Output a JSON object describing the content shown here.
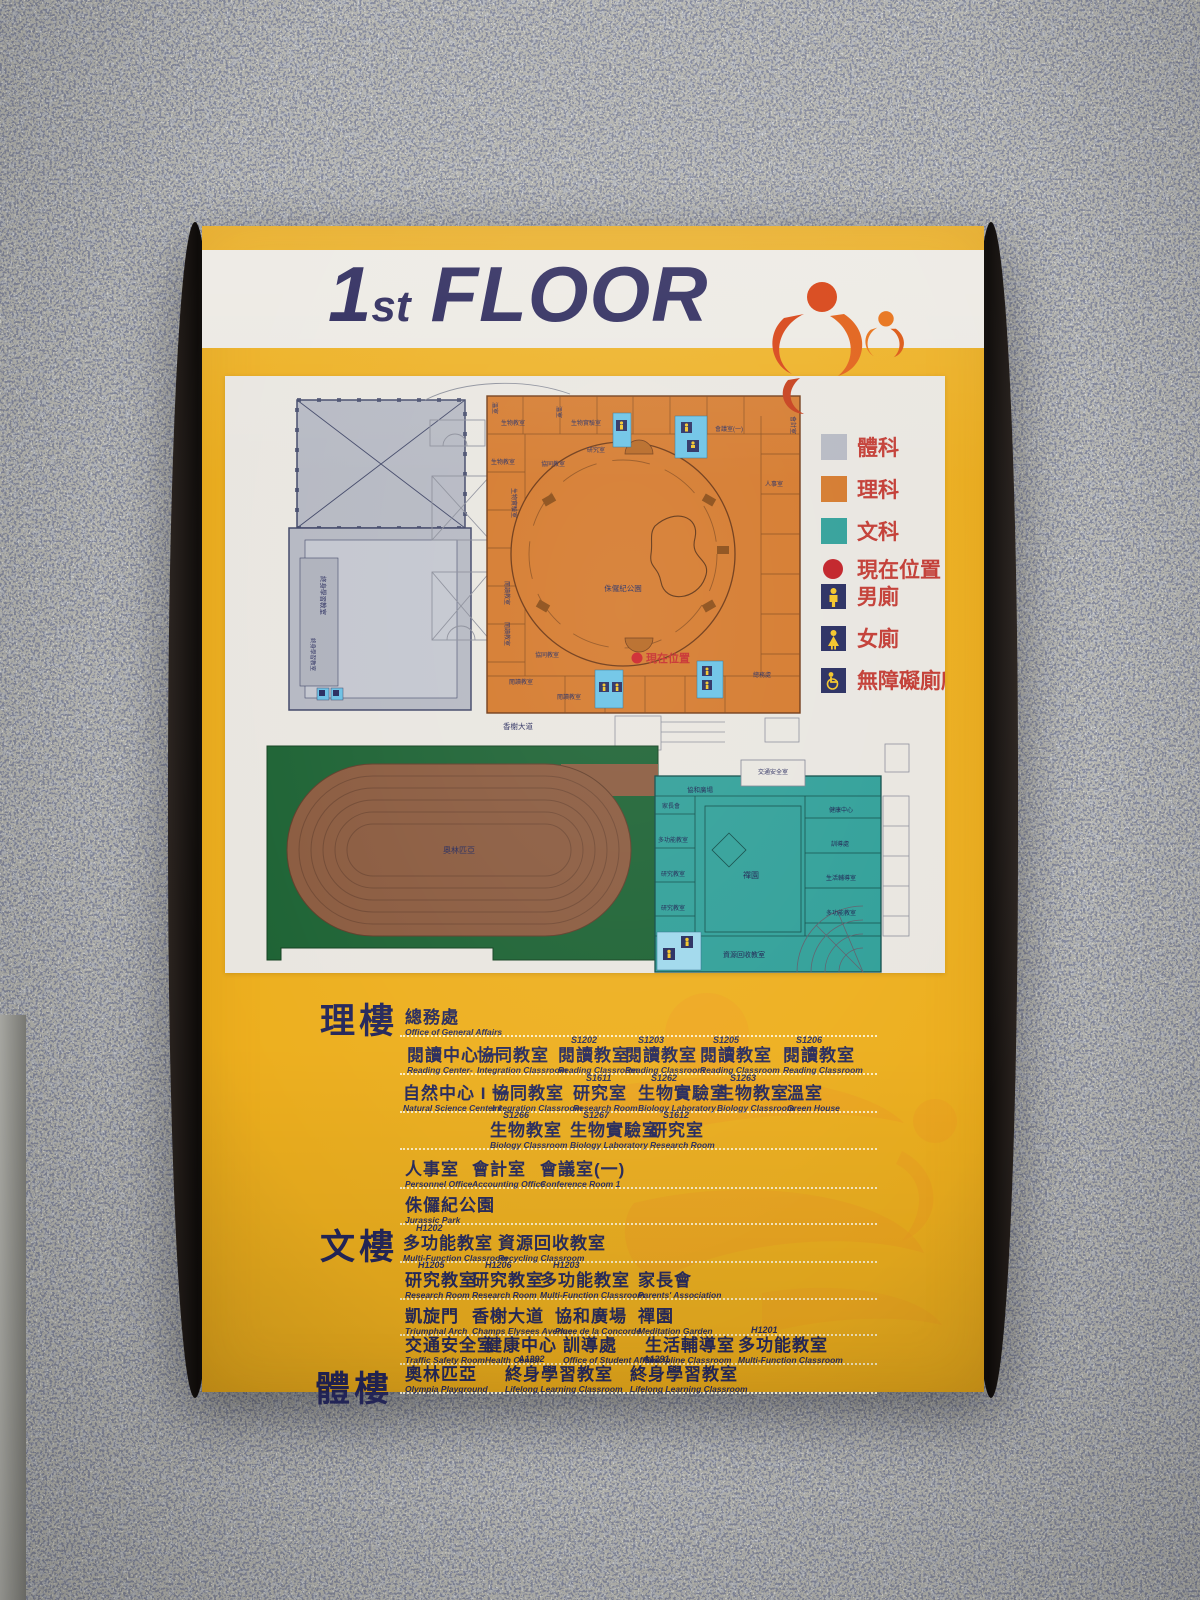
{
  "sign": {
    "title_num": "1",
    "title_sup": "st",
    "title_word": "FLOOR"
  },
  "legend": {
    "areas": [
      {
        "label": "體科",
        "color": "#b5b8c2"
      },
      {
        "label": "理科",
        "color": "#d4782a"
      },
      {
        "label": "文科",
        "color": "#2f9f98"
      }
    ],
    "markers": [
      {
        "label": "現在位置",
        "icon": "current-location-dot",
        "color": "#c01d24"
      },
      {
        "label": "男廁",
        "icon": "male-restroom-icon"
      },
      {
        "label": "女廁",
        "icon": "female-restroom-icon"
      },
      {
        "label": "無障礙廁所",
        "icon": "accessible-restroom-icon"
      }
    ]
  },
  "map": {
    "road_label": "香榭大道",
    "field_label": "奧林匹亞",
    "current_location": "現在位置",
    "orange_labels": [
      "溫室",
      "生物教室",
      "溫室",
      "生物實驗室",
      "研究室",
      "生物教室",
      "協同教室",
      "生物實驗室",
      "閱讀教室",
      "閱讀教室",
      "協同教室",
      "閱讀教室",
      "閱讀教室",
      "會議室(一)",
      "會計室",
      "人事室",
      "總務處",
      "侏儸紀公園"
    ],
    "teal_labels": [
      "協和廣場",
      "交通安全室",
      "家長會",
      "多功能教室",
      "研究教室",
      "研究教室",
      "禪園",
      "健康中心",
      "訓導處",
      "生活輔導室",
      "多功能教室",
      "資源回收教室"
    ],
    "gray_labels": [
      "終身學習教室",
      "終身學習教室"
    ]
  },
  "directory": {
    "sections": [
      {
        "label": "理樓",
        "rows": [
          [
            {
              "code": "",
              "zh": "總務處",
              "en": "Office of General Affairs"
            }
          ],
          [
            {
              "code": "",
              "zh": "閱讀中心 一",
              "en": "Reading Center-"
            },
            {
              "code": "",
              "zh": "協同教室",
              "en": "Integration Classroom"
            },
            {
              "code": "S1202",
              "zh": "閱讀教室",
              "en": "Reading Classroom"
            },
            {
              "code": "S1203",
              "zh": "閱讀教室",
              "en": "Reading Classroom"
            },
            {
              "code": "S1205",
              "zh": "閱讀教室",
              "en": "Reading Classroom"
            },
            {
              "code": "S1206",
              "zh": "閱讀教室",
              "en": "Reading Classroom"
            }
          ],
          [
            {
              "code": "",
              "zh": "自然中心 I 一",
              "en": "Natural Science Center I"
            },
            {
              "code": "",
              "zh": "協同教室",
              "en": "Integration Classroom"
            },
            {
              "code": "S1611",
              "zh": "研究室",
              "en": "Research Room"
            },
            {
              "code": "S1262",
              "zh": "生物實驗室",
              "en": "Biology Laboratory"
            },
            {
              "code": "S1263",
              "zh": "生物教室",
              "en": "Biology Classroom"
            },
            {
              "code": "",
              "zh": "溫室",
              "en": "Green House"
            }
          ],
          [
            {
              "code": "S1266",
              "zh": "生物教室",
              "en": "Biology Classroom"
            },
            {
              "code": "S1267",
              "zh": "生物實驗室",
              "en": "Biology Laboratory"
            },
            {
              "code": "S1612",
              "zh": "研究室",
              "en": "Research Room"
            }
          ],
          [
            {
              "code": "",
              "zh": "人事室",
              "en": "Personnel Office"
            },
            {
              "code": "",
              "zh": "會計室",
              "en": "Accounting Office"
            },
            {
              "code": "",
              "zh": "會議室(一)",
              "en": "Conference Room 1"
            }
          ],
          [
            {
              "code": "",
              "zh": "侏儸紀公園",
              "en": "Jurassic Park"
            }
          ]
        ]
      },
      {
        "label": "文樓",
        "rows": [
          [
            {
              "code": "H1202",
              "zh": "多功能教室",
              "en": "Multi-Function Classroom"
            },
            {
              "code": "",
              "zh": "資源回收教室",
              "en": "Recycling Classroom"
            }
          ],
          [
            {
              "code": "H1205",
              "zh": "研究教室",
              "en": "Research Room"
            },
            {
              "code": "H1206",
              "zh": "研究教室",
              "en": "Research Room"
            },
            {
              "code": "H1203",
              "zh": "多功能教室",
              "en": "Multi-Function Classroom"
            },
            {
              "code": "",
              "zh": "家長會",
              "en": "Parents' Association"
            }
          ],
          [
            {
              "code": "",
              "zh": "凱旋門",
              "en": "Triumphal Arch"
            },
            {
              "code": "",
              "zh": "香榭大道",
              "en": "Champs Elysees Avenue"
            },
            {
              "code": "",
              "zh": "協和廣場",
              "en": "Place de la Concorde"
            },
            {
              "code": "",
              "zh": "禪園",
              "en": "Meditation Garden"
            }
          ],
          [
            {
              "code": "",
              "zh": "交通安全室",
              "en": "Traffic Safety Room"
            },
            {
              "code": "",
              "zh": "健康中心",
              "en": "Health Center"
            },
            {
              "code": "",
              "zh": "訓導處",
              "en": "Office of Student Affairs"
            },
            {
              "code": "",
              "zh": "生活輔導室",
              "en": "Discipline Classroom"
            },
            {
              "code": "H1201",
              "zh": "多功能教室",
              "en": "Multi-Function Classroom"
            }
          ]
        ]
      },
      {
        "label": "體樓",
        "rows": [
          [
            {
              "code": "",
              "zh": "奧林匹亞",
              "en": "Olympia Playground"
            },
            {
              "code": "A1292",
              "zh": "終身學習教室",
              "en": "Lifelong Learning Classroom"
            },
            {
              "code": "A1291",
              "zh": "終身學習教室",
              "en": "Lifelong Learning Classroom"
            }
          ]
        ]
      }
    ]
  }
}
